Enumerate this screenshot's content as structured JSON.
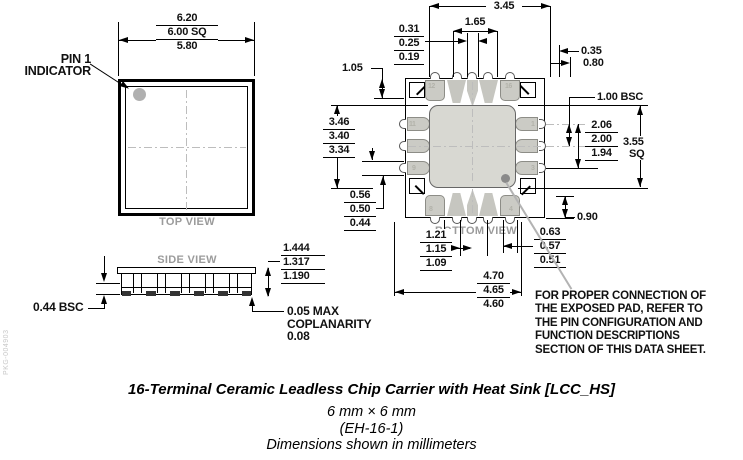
{
  "document": {
    "side_code": "PKG-004903"
  },
  "top_view": {
    "label": "TOP VIEW",
    "pin1_line1": "PIN 1",
    "pin1_line2": "INDICATOR",
    "dim_body_sq": [
      "6.20",
      "6.00 SQ",
      "5.80"
    ]
  },
  "side_view": {
    "label": "SIDE VIEW",
    "dim_height": [
      "1.444",
      "1.317",
      "1.190"
    ],
    "dim_lead_pitch": "0.44 BSC",
    "coplanarity_line1": "0.05 MAX",
    "coplanarity_line2": "COPLANARITY",
    "coplanarity_line3": "0.08"
  },
  "bottom_view": {
    "label": "BOTTOM VIEW",
    "dim_terminal_span": "3.45",
    "dim_inner_pitch": "1.65",
    "dim_lead_width": [
      "0.31",
      "0.25",
      "0.19"
    ],
    "dim_edge_offset": "0.35",
    "dim_corner_offset": "0.80",
    "dim_corner_pad": "1.05",
    "dim_epad_height": [
      "3.46",
      "3.40",
      "3.34"
    ],
    "dim_pad_gap": [
      "0.56",
      "0.50",
      "0.44"
    ],
    "dim_pitch": "1.00 BSC",
    "dim_pad_span": [
      "2.06",
      "2.00",
      "1.94"
    ],
    "dim_epad_sq_1": "3.55",
    "dim_epad_sq_2": "SQ",
    "dim_bottom_offset": "0.90",
    "dim_pad_width": [
      "0.63",
      "0.57",
      "0.51"
    ],
    "dim_inner_span": [
      "1.21",
      "1.15",
      "1.09"
    ],
    "dim_outer_span": [
      "4.70",
      "4.65",
      "4.60"
    ],
    "pad_numbers": {
      "p12": "12",
      "p16": "16",
      "p11": "11",
      "p9": "9",
      "p1": "1",
      "p3": "3",
      "p8": "8",
      "p4": "4"
    }
  },
  "note_lines": {
    "l1": "FOR PROPER CONNECTION OF",
    "l2": "THE EXPOSED PAD, REFER TO",
    "l3": "THE PIN CONFIGURATION AND",
    "l4": "FUNCTION DESCRIPTIONS",
    "l5": "SECTION OF THIS DATA SHEET."
  },
  "caption": {
    "title": "16-Terminal Ceramic Leadless Chip Carrier with Heat Sink [LCC_HS]",
    "size": "6 mm × 6 mm",
    "package_code": "(EH-16-1)",
    "units": "Dimensions shown in millimeters"
  }
}
